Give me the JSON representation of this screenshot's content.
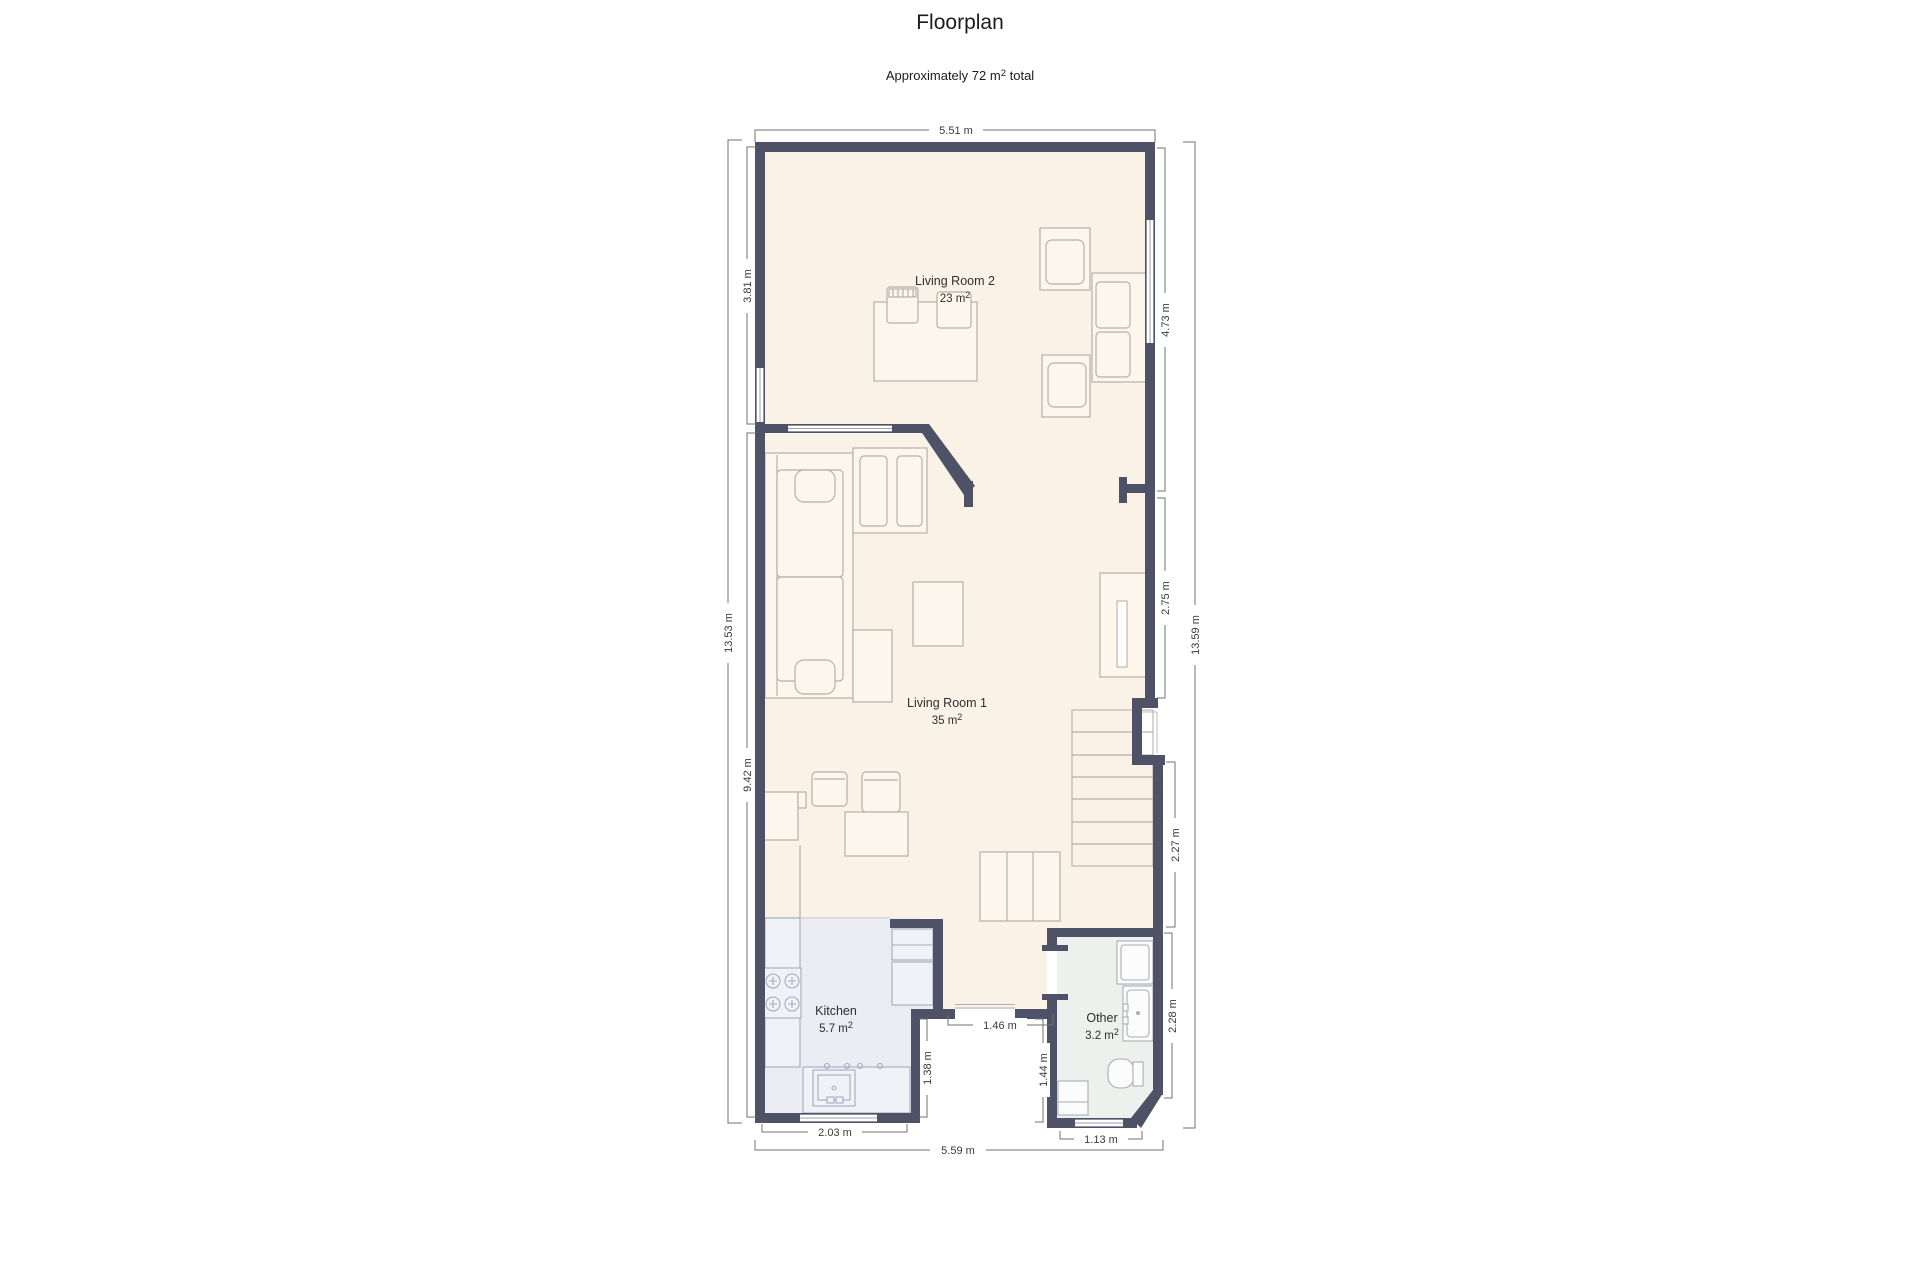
{
  "title": "Floorplan",
  "subtitle": {
    "prefix": "Approximately 72 m",
    "sup": "2",
    "suffix": " total"
  },
  "rooms": [
    {
      "name": "Living Room 2",
      "area": "23 m",
      "area_sup": "2"
    },
    {
      "name": "Living Room 1",
      "area": "35 m",
      "area_sup": "2"
    },
    {
      "name": "Kitchen",
      "area": "5.7 m",
      "area_sup": "2"
    },
    {
      "name": "Other",
      "area": "3.2 m",
      "area_sup": "2"
    }
  ],
  "dims": {
    "top": "5.51 m",
    "bottom": "5.59 m",
    "kitchen_width": "2.03 m",
    "other_width": "1.13 m",
    "left_total": "13.53 m",
    "lr2_height": "3.81 m",
    "lower_height": "9.42 m",
    "right_total": "13.59 m",
    "lr2_right": "4.73 m",
    "mid_right": "2.75 m",
    "stairs": "2.27 m",
    "other_right": "2.28 m",
    "entry": "1.46 m",
    "kitchen_recess": "1.38 m",
    "other_recess": "1.44 m"
  },
  "colors": {
    "wall": "#4e5266",
    "floor_main": "#faf2e6",
    "floor_kitchen": "#ebecf4",
    "floor_other": "#eef0ee",
    "dimension_line": "#707070"
  }
}
